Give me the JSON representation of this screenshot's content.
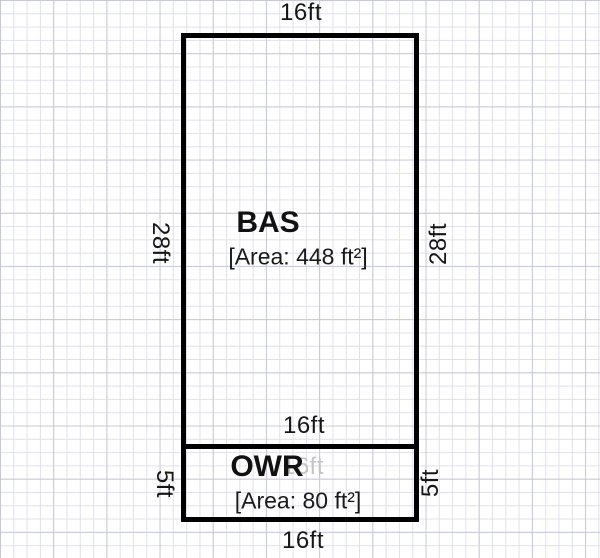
{
  "diagram": {
    "type": "floorplan-sketch",
    "rooms": [
      {
        "code": "BAS",
        "area_text": "[Area: 448 ft²]",
        "area_sqft": 448,
        "width_ft": 16,
        "height_ft": 28,
        "dim_labels": {
          "top": "16ft",
          "left": "28ft",
          "right": "28ft",
          "bottom": "16ft"
        }
      },
      {
        "code": "OWR",
        "area_text": "[Area: 80 ft²]",
        "area_sqft": 80,
        "width_ft": 16,
        "height_ft": 5,
        "dim_labels": {
          "top_ghost": "16ft",
          "left": "5ft",
          "right": "5ft",
          "bottom": "16ft"
        }
      }
    ],
    "colors": {
      "outline": "#000000",
      "text": "#161616",
      "ghost_text": "#c4c4c4",
      "grid_minor": "#e0e0ea",
      "grid_major": "#c8c9d7",
      "paper": "#ffffff"
    }
  }
}
